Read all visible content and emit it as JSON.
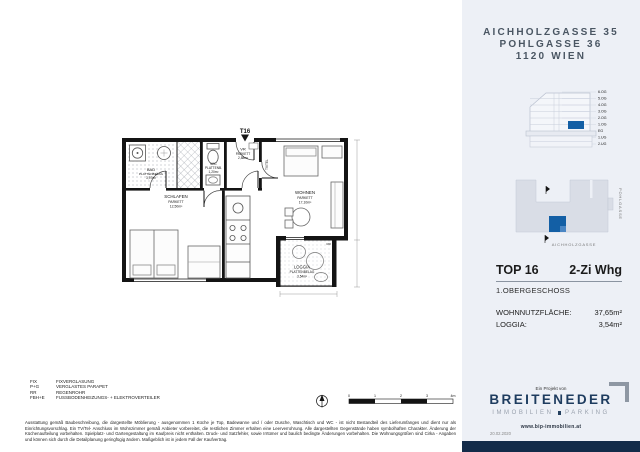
{
  "header": {
    "address_lines": [
      "AICHHOLZGASSE 35",
      "POHLGASSE 36",
      "1120 WIEN"
    ]
  },
  "section_diagram": {
    "floor_labels": [
      "6.OG",
      "5.OG",
      "4.OG",
      "3.OG",
      "2.OG",
      "1.OG",
      "EG",
      "1.UG",
      "2.UG"
    ]
  },
  "site_plan": {
    "street_right": "POHLGASSE",
    "street_bottom": "AICHHOLZGASSE"
  },
  "unit_info": {
    "top": "TOP 16",
    "type": "2-Zi Whg",
    "floor": "1.OBERGESCHOSS",
    "rows": [
      {
        "label": "WOHNNUTZFLÄCHE:",
        "value": "37,65m²"
      },
      {
        "label": "LOGGIA:",
        "value": "3,54m²"
      }
    ]
  },
  "logo": {
    "pre": "Ein Projekt von",
    "name": "BREITENEDER",
    "sub_left": "IMMOBILIEN",
    "sub_right": "PARKING",
    "url": "www.bip-immobilien.at",
    "date": "20.02.2020"
  },
  "floor_plan": {
    "entrance_label": "T16",
    "rooms": [
      {
        "name": "VR",
        "finish": "PARKETT",
        "area": "2,88m²"
      },
      {
        "name": "WC",
        "finish": "PLATTENB.",
        "area": "1,20m²"
      },
      {
        "name": "BAD",
        "finish": "PLATTENBELAG",
        "area": "3,97m²"
      },
      {
        "name": "SCHLAFEN",
        "finish": "PARKETT",
        "area": "12,50m²"
      },
      {
        "name": "WOHNEN",
        "finish": "PARKETT",
        "area": "17,10m²"
      },
      {
        "name": "LOGGIA",
        "finish": "PLATTENBELAG",
        "area": "3,54m²"
      }
    ],
    "annotations": {
      "tv_tel": "TV/TEL",
      "rr": "RR"
    }
  },
  "legend": [
    {
      "abbr": "FIX",
      "desc": "FIXVERGLASUNG"
    },
    {
      "abbr": "P+G",
      "desc": "VERGLASTES PARAPET"
    },
    {
      "abbr": "RR",
      "desc": "REGENROHR"
    },
    {
      "abbr": "FBH+E",
      "desc": "FUSSBODENHEIZUNGS- + ELEKTROVERTEILER"
    }
  ],
  "scale_bar": {
    "ticks": [
      "0",
      "1",
      "2",
      "3",
      "4m"
    ]
  },
  "disclaimer": "Ausstattung gemäß Baubeschreibung, die dargestellte Möblierung - ausgenommen 1 Küche je Top, Badewanne und / oder Dusche, Waschtisch und WC - ist nicht Bestandteil des Lieferumfanges und dient nur als Einrichtungsvorschlag. Ein TV/Tel- Anschluss im Wohnzimmer gemäß Anbieter vorbereitet, die restlichen Zimmer erhalten eine Leerverrohrung. Alle dargestellten Gegenstände haben symbolhaften Charakter. Änderung der Küchenaufteilung vorbehalten. Spielplatz- und Gartengestaltung im Kaufpreis nicht enthalten. Druck- und Satzfehler, sowie Irrtümer und baulich bedingte Änderungen vorbehalten. Die Wohnungsgrößen sind Cirka - Angaben und können sich durch die Detailplanung geringfügig ändern. Maßgeblich ist in jedem Fall der Kaufvertrag.",
  "colors": {
    "accent_blue": "#135fa5",
    "logo_navy": "#1e3c5f",
    "panel_bg": "#edf0f6",
    "footprint_gray": "#d9dde6"
  }
}
